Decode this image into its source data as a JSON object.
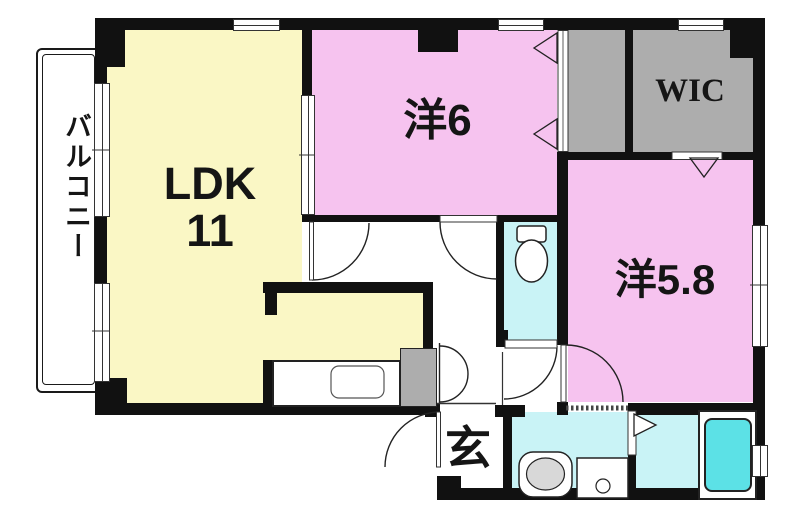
{
  "page": {
    "background": "#ffffff"
  },
  "colors": {
    "wall": "#111111",
    "ldk_fill": "#faf7c5",
    "bedroom_fill": "#f6c3ef",
    "wet_fill": "#c9f3f6",
    "tub_fill": "#5ce1e6",
    "closet_fill": "#adadad",
    "fixture_gray": "#d8d8d8",
    "line": "#333333"
  },
  "floorplan": {
    "balcony": {
      "label": "バルコニー"
    },
    "ldk": {
      "label": "LDK",
      "size": "11"
    },
    "bedroom6": {
      "label": "洋6"
    },
    "wic": {
      "label": "WIC"
    },
    "bedroom58": {
      "label": "洋5.8"
    },
    "entrance": {
      "label": "玄"
    },
    "fixtures": {
      "toilet": "toilet-icon",
      "sink": "sink-icon",
      "washing_machine": "washer-pan-icon",
      "bathtub": "bathtub-icon",
      "kitchen_sink": "kitchen-sink-icon"
    }
  }
}
